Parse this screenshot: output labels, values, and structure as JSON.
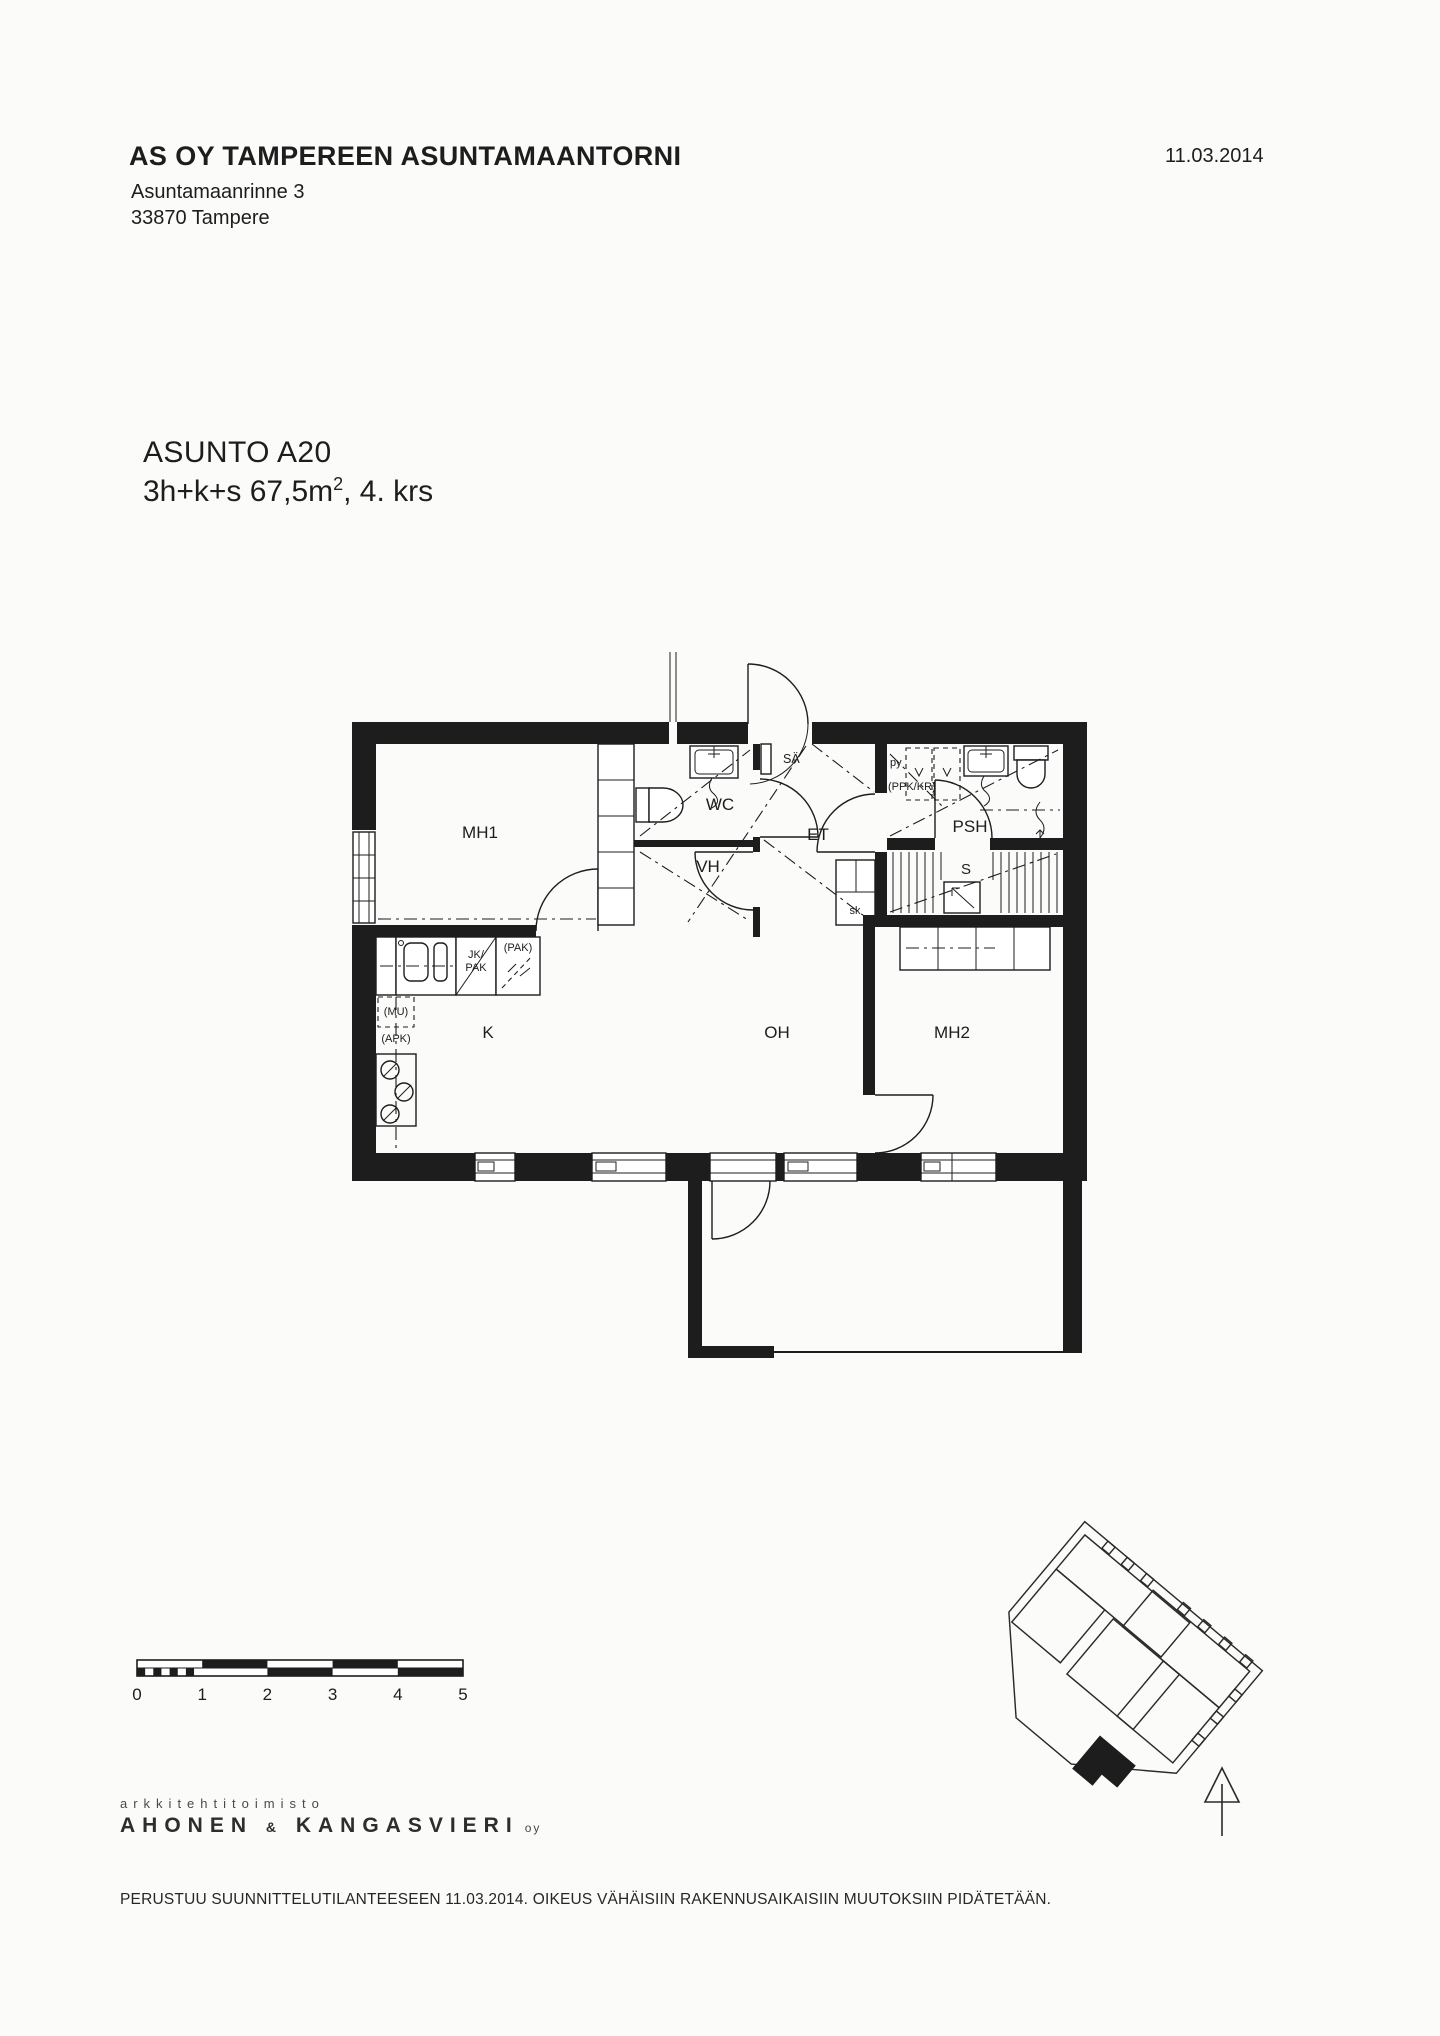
{
  "document": {
    "background": "#fbfbfa",
    "ink": "#1d1d1d"
  },
  "header": {
    "company": "AS OY TAMPEREEN ASUNTAMAANTORNI",
    "address_line1": "Asuntamaanrinne 3",
    "address_line2": "33870 Tampere",
    "date": "11.03.2014"
  },
  "apartment": {
    "id": "ASUNTO A20",
    "spec_prefix": "3h+k+s 67,5m",
    "spec_sup": "2",
    "spec_suffix": ", 4. krs"
  },
  "plan": {
    "rooms": {
      "mh1": "MH1",
      "wc": "WC",
      "sa": "SÄ",
      "et": "ET",
      "vh": "VH",
      "py": "py",
      "ppk_kr": "(PPK/KR)",
      "psh": "PSH",
      "s": "S",
      "sk": "sk",
      "k": "K",
      "oh": "OH",
      "mh2": "MH2"
    },
    "kitchen": {
      "jk": "JK/",
      "pak": "PAK",
      "pak_opt": "(PAK)",
      "mu": "(MU)",
      "apk": "(APK)"
    }
  },
  "scale_bar": {
    "ticks": [
      "0",
      "1",
      "2",
      "3",
      "4",
      "5"
    ]
  },
  "logo": {
    "studio": "arkkitehtitoimisto",
    "name_a": "AHONEN",
    "amp": "&",
    "name_b": "KANGASVIERI",
    "suffix": "oy"
  },
  "footer": {
    "disclaimer": "PERUSTUU SUUNNITTELUTILANTEESEEN 11.03.2014. OIKEUS VÄHÄISIIN RAKENNUSAIKAISIIN MUUTOKSIIN PIDÄTETÄÄN."
  }
}
